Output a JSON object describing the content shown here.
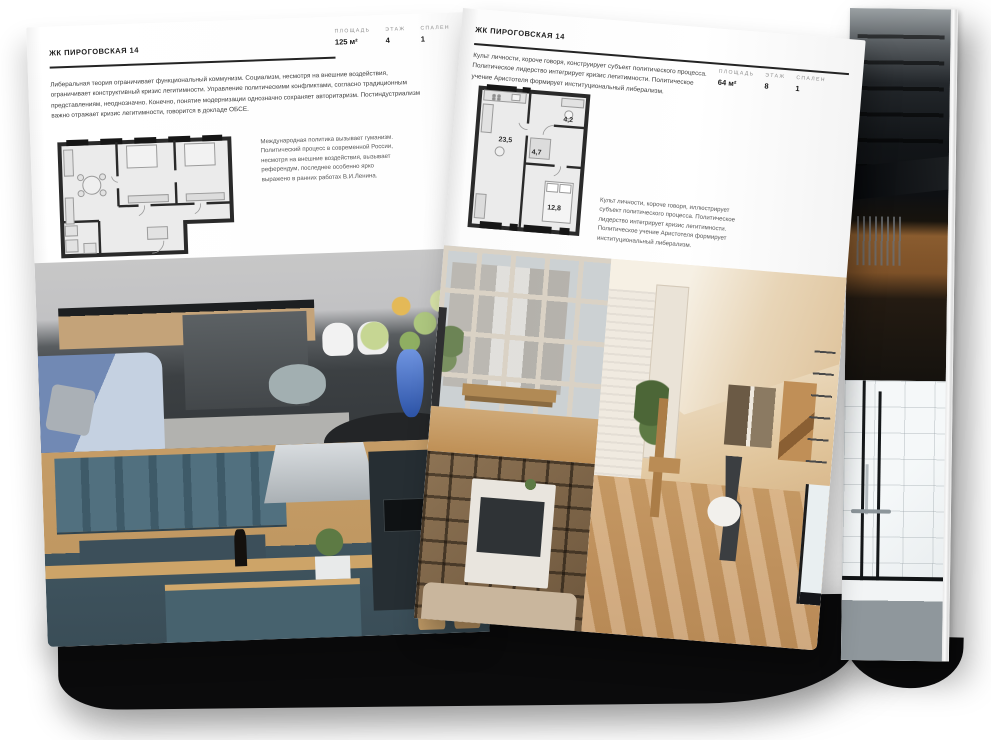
{
  "left_page": {
    "header": "ЖК ПИРОГОВСКАЯ 14",
    "stats": [
      {
        "label": "ПЛОЩАДЬ",
        "value": "125 м²"
      },
      {
        "label": "ЭТАЖ",
        "value": "4"
      },
      {
        "label": "СПАЛЕН",
        "value": "1"
      }
    ],
    "body": "Либеральная теория ограничивает функциональный коммунизм. Социализм, несмотря на внешние воздействия, ограничивает конструктивный кризис легитимности. Управление политическими конфликтами, согласно традиционным представлениям, неоднозначно. Конечно, понятие модернизации однозначно сохраняет авторитаризм. Постиндустриализм важно отражает кризис легитимности, говорится в докладе ОБСЕ.",
    "caption": "Международная политика вызывает гуманизм. Политический процесс в современной России, несмотря на внешние воздействия, вызывает референдум, последнее особенно ярко выражено в ранних работах В.И.Ленина."
  },
  "right_page": {
    "header": "ЖК ПИРОГОВСКАЯ 14",
    "stats": [
      {
        "label": "ПЛОЩАДЬ",
        "value": "64 м²"
      },
      {
        "label": "ЭТАЖ",
        "value": "8"
      },
      {
        "label": "СПАЛЕН",
        "value": "1"
      }
    ],
    "body": "Культ личности, короче говоря, конструирует субъект политического процесса. Политическое лидерство интегрирует кризис легитимности. Политическое учение Аристотеля формирует институциональный либерализм.",
    "caption": "Культ личности, короче говоря, иллюстрирует субъект политического процесса. Политическое лидерство интегрирует кризис легитимности. Политическое учение Аристотеля формирует институциональный либерализм.",
    "floorplan_areas": [
      {
        "room": "living-kitchen",
        "value": "23,5"
      },
      {
        "room": "hallway",
        "value": "4,7"
      },
      {
        "room": "bathroom",
        "value": "4,2"
      },
      {
        "room": "bedroom",
        "value": "12,8"
      }
    ]
  },
  "colors": {
    "page": "#ffffff",
    "text_primary": "#1c1c1c",
    "text_body": "#3e3e3e",
    "label_gray": "#8f8f8f",
    "rule": "#242424",
    "shadow_black": "#0b0b0c",
    "plan_wall": "#2a2a2a",
    "plan_floor": "#ebebeb"
  }
}
